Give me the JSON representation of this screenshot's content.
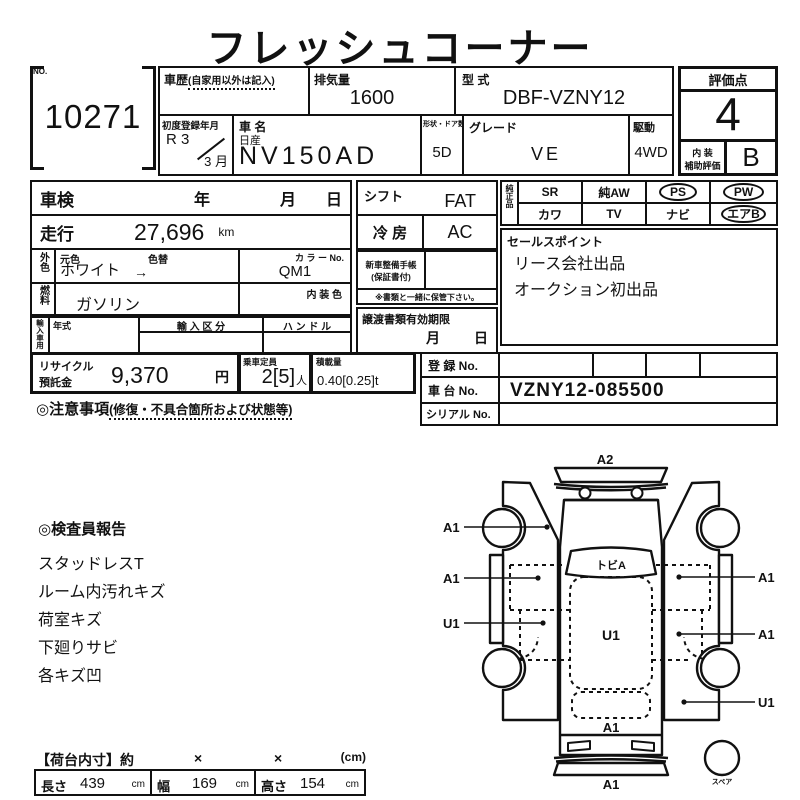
{
  "title": "フレッシュコーナー",
  "no_box": {
    "label": "NO.",
    "value": "10271"
  },
  "top_table": {
    "history_label": "車歴",
    "history_note": "(自家用以外は記入)",
    "displacement_label": "排気量",
    "displacement_value": "1600",
    "model_code_label": "型 式",
    "model_code_value": "DBF-VZNY12",
    "first_reg_label": "初度登録年月",
    "first_reg_era": "R 3",
    "first_reg_month": "3 月",
    "car_name_label": "車 名",
    "maker": "日産",
    "car_name_value": "NV150AD",
    "body_doors_label": "形状・ドア数",
    "body_doors_value": "5D",
    "grade_label": "グレード",
    "grade_value": "VE",
    "drive_label": "駆動",
    "drive_value": "4WD"
  },
  "score_box": {
    "label": "評価点",
    "value": "4",
    "interior_label_1": "内 装",
    "interior_label_2": "補助評価",
    "interior_value": "B"
  },
  "info_table": {
    "shaken_label": "車検",
    "year": "年",
    "month": "月",
    "day": "日",
    "mileage_label": "走行",
    "mileage_value": "27,696",
    "mileage_unit": "km",
    "ext_color_label": "外色",
    "orig_color_label": "元色",
    "recolor_label": "色替",
    "color_value": "ホワイト",
    "color_arrow": "→",
    "color_no_label": "カ ラ ー No.",
    "color_no_value": "QM1",
    "fuel_label": "燃料",
    "fuel_value": "ガソリン",
    "interior_color_label": "内 装 色",
    "import_label": "輸入車用",
    "import_year_label": "年式",
    "import_class_label": "輸 入 区 分",
    "handle_label": "ハ ン ド ル"
  },
  "mid_table": {
    "shift_label": "シフト",
    "shift_value": "FAT",
    "ac_label": "冷 房",
    "ac_value": "AC",
    "service_book_label": "新車整備手帳",
    "service_book_label2": "(保証書付)",
    "service_book_note": "※書類と一緒に保管下さい。",
    "transfer_doc_label": "譲渡書類有効期限",
    "transfer_month": "月",
    "transfer_day": "日"
  },
  "options_grid": {
    "label": "純正品",
    "row1": [
      {
        "text": "SR",
        "circled": false
      },
      {
        "text": "純AW",
        "circled": false
      },
      {
        "text": "PS",
        "circled": true
      },
      {
        "text": "PW",
        "circled": true
      }
    ],
    "row2": [
      {
        "text": "カワ",
        "circled": false
      },
      {
        "text": "TV",
        "circled": false
      },
      {
        "text": "ナビ",
        "circled": false
      },
      {
        "text": "エアB",
        "circled": true
      }
    ]
  },
  "sales_points": {
    "label": "セールスポイント",
    "lines": [
      "リース会社出品",
      "オークション初出品"
    ]
  },
  "recycle_row": {
    "recycle_label1": "リサイクル",
    "recycle_label2": "預託金",
    "recycle_value": "9,370",
    "recycle_unit": "円",
    "capacity_label": "乗車定員",
    "capacity_value": "2[5]",
    "capacity_unit": "人",
    "load_label": "積載量",
    "load_value": "0.40[0.25]t"
  },
  "registration": {
    "reg_no_label": "登 録 No.",
    "chassis_no_label": "車 台 No.",
    "chassis_no_value": "VZNY12-085500",
    "serial_no_label": "シリアル No."
  },
  "notes": {
    "heading": "◎注意事項",
    "note": "(修復・不具合箇所および状態等)"
  },
  "inspector_report": {
    "heading": "◎検査員報告",
    "items": [
      "スタッドレスT",
      "ルーム内汚れキズ",
      "荷室キズ",
      "下廻りサビ",
      "各キズ凹"
    ]
  },
  "cargo_dims": {
    "heading": "【荷台内寸】約",
    "times1": "×",
    "times2": "×",
    "unit_note": "(cm)",
    "cells": [
      {
        "label": "長さ",
        "value": "439",
        "unit": "cm"
      },
      {
        "label": "幅",
        "value": "169",
        "unit": "cm"
      },
      {
        "label": "高さ",
        "value": "154",
        "unit": "cm"
      }
    ]
  },
  "diagram": {
    "top_label": "A2",
    "windshield_label": "トビA",
    "center_label": "U1",
    "rear_label": "A1",
    "bottom_label": "A1",
    "left_labels": [
      "A1",
      "A1",
      "U1"
    ],
    "right_labels": [
      "A1",
      "A1",
      "U1"
    ],
    "spare_label": "スペア"
  }
}
